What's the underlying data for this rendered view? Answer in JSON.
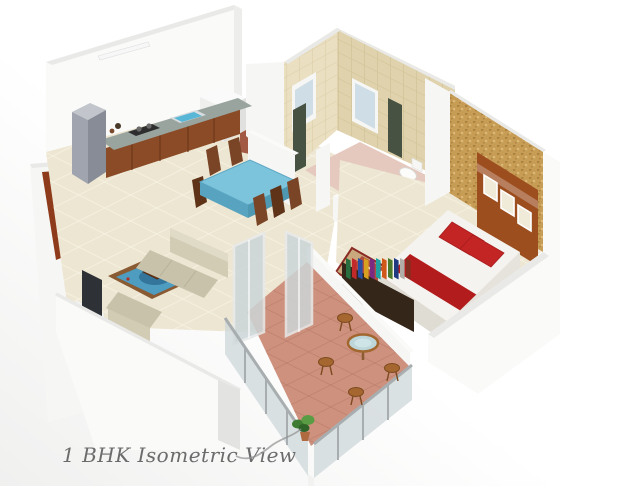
{
  "caption": "1 BHK Isometric View",
  "scene": {
    "type": "isometric-floor-plan-render",
    "unit": "1 BHK",
    "rooms": [
      {
        "id": "kitchen",
        "items": [
          "refrigerator",
          "gas-stove",
          "sink",
          "counter-cabinets",
          "washing-machine",
          "wall-light"
        ]
      },
      {
        "id": "dining",
        "items": [
          "dining-table-blue-top",
          "wooden-chairs"
        ]
      },
      {
        "id": "living",
        "items": [
          "sofa-set",
          "coffee-table",
          "blue-rug",
          "tv-unit",
          "entrance-door"
        ]
      },
      {
        "id": "bathroom",
        "items": [
          "shower-panels",
          "windows",
          "toilet",
          "bathtub",
          "partition-walls"
        ]
      },
      {
        "id": "bedroom",
        "items": [
          "double-bed",
          "red-pillows",
          "headboard-panel",
          "textured-accent-wall",
          "patterned-rug",
          "book-rack"
        ]
      },
      {
        "id": "balcony",
        "items": [
          "round-glass-table",
          "wooden-stools",
          "potted-plant",
          "glass-railing",
          "sliding-glass-doors"
        ]
      }
    ]
  },
  "palette": {
    "bg": "#ffffff",
    "bg_shade": "#f1f1f0",
    "wall_white": "#fafaf8",
    "wall_light": "#f6f6f4",
    "wall_cap": "#e9e9e7",
    "wall_side": "#ededeb",
    "wall_shade": "#e3e3e1",
    "floor_cream": "#EDE6D2",
    "floor_grout": "#f8f4e6",
    "corridor_floor": "#A35A44",
    "bath_tile_light": "#EADFC0",
    "bath_tile_dark": "#DFD2AC",
    "tile_grout_light": "#d9cca6",
    "tile_grout_dark": "#cfc092",
    "bath_floor": "#E5C9BE",
    "window_glass": "#cfdde6",
    "window_frame": "#f6f6f4",
    "shower_dark": "#475242",
    "accent_wall": "#C79C55",
    "accent_dot_dark": "#ab823f",
    "accent_dot_light": "#dcb878",
    "headboard": "#9C4E1F",
    "frame_fill": "#f0ead8",
    "fridge_top": "#c2c6cc",
    "fridge_front": "#9fa4ae",
    "fridge_side": "#878c96",
    "counter_top": "#9aa49e",
    "cabinet": "#8a4b26",
    "cabinet_line": "#6e3a1c",
    "sink": "#58b6d6",
    "stove": "#2e2e2e",
    "machine_top": "#fafafa",
    "machine_left": "#efefed",
    "machine_right": "#e0e0de",
    "table_blue": "#7cc4dc",
    "table_blue_side": "#58a4c0",
    "chair_brown": "#7A4526",
    "chair_dark": "#5e3318",
    "sofa": "#d2ccb5",
    "sofa_light": "#e0dbc7",
    "sofa_seat": "#c8c2ab",
    "rug_border": "#8a5a33",
    "rug_blue": "#4e9cc0",
    "rug_blue_dark": "#2f6e94",
    "tv": "#2e3236",
    "tv_cabinet": "#f1f1ef",
    "door_frame": "#8E3B1B",
    "door_panel": "#9b9b9b",
    "bed_white": "#f5f3ef",
    "bed_edge": "#dfdcd4",
    "bed_red": "#C32424",
    "runner_red": "#B21C1C",
    "bedroom_rug_base": "#C9A87E",
    "bedroom_rug_red": "#a83028",
    "shelf": "#35261a",
    "books": [
      "#2a6e3f",
      "#c02a2a",
      "#2a4ea0",
      "#d8a020",
      "#7a2a80",
      "#20a0a0",
      "#d05818",
      "#4a7a2a",
      "#203a80",
      "#b0b0a8",
      "#803020"
    ],
    "balcony_floor": "#CE917E",
    "balcony_grout": "#bb7b69",
    "glass": "#ccd6d8",
    "glass_frame": "#e6e8e8",
    "metal": "#a8aeb0",
    "table_glass": "#bdd6da",
    "stool": "#A5672F",
    "stool_dark": "#7c4a1e",
    "plant": "#3e7c33",
    "plant_light": "#5a9c44",
    "caption_color": "#6b6b6b",
    "flourish": "#909090"
  }
}
